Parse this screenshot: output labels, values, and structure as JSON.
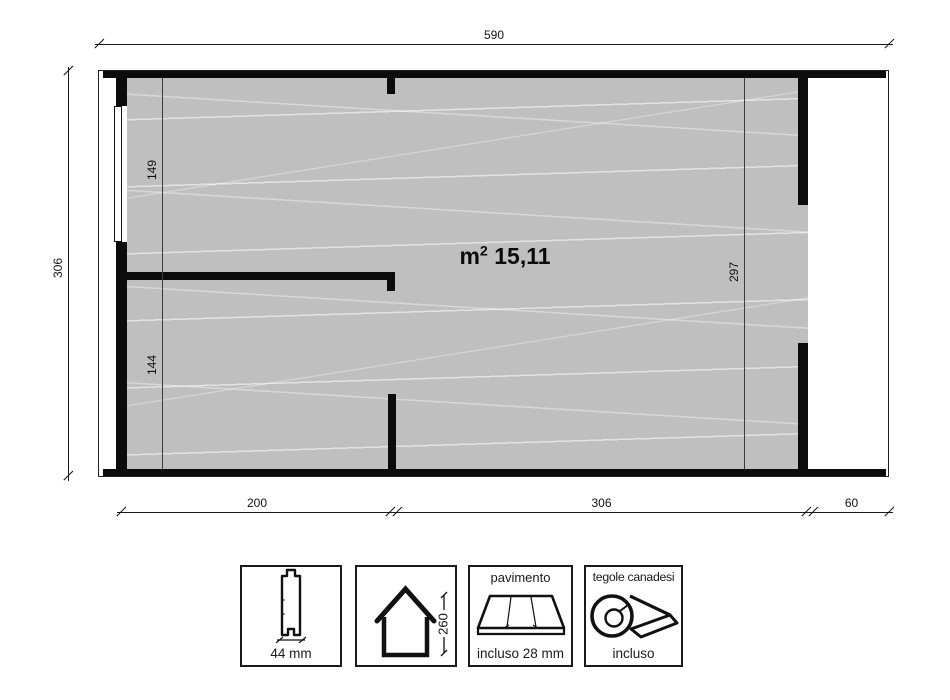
{
  "plan": {
    "area": {
      "unit": "m",
      "sup": "2",
      "value": "15,11"
    },
    "dims": {
      "total_width": "590",
      "total_depth": "306",
      "room_top_depth": "149",
      "room_bottom_depth": "144",
      "main_room_depth": "297",
      "bottom_left": "200",
      "bottom_middle": "306",
      "bottom_right": "60"
    }
  },
  "legend": {
    "plank": {
      "label": "44 mm"
    },
    "house": {
      "height_label": "260"
    },
    "floor": {
      "title": "pavimento",
      "note": "incluso 28 mm"
    },
    "roof": {
      "title": "tegole canadesi",
      "note": "incluso"
    }
  },
  "colors": {
    "floor": "#bfbfbf",
    "wall": "#0c0c0c",
    "line": "#1a1a1a"
  }
}
